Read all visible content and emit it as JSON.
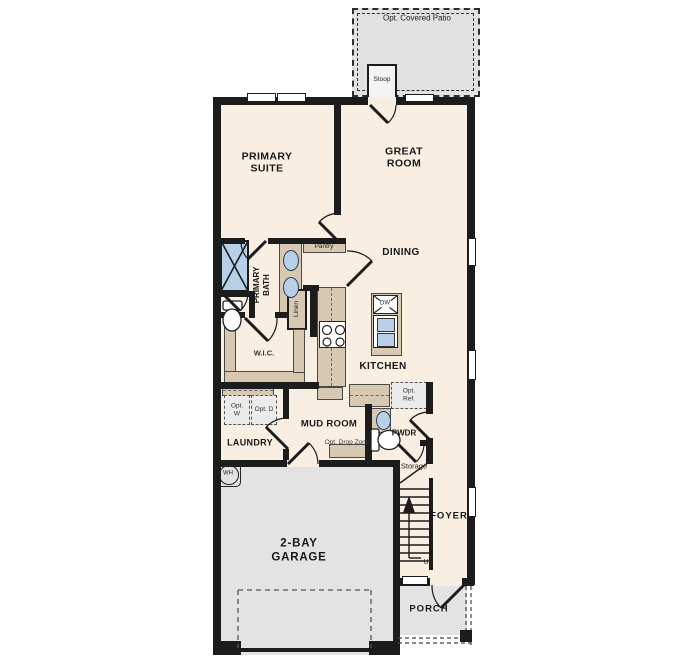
{
  "plan": {
    "rooms": {
      "primary_suite": "PRIMARY SUITE",
      "great_room": "GREAT ROOM",
      "dining": "DINING",
      "kitchen": "KITCHEN",
      "primary_bath": "PRIMARY BATH",
      "wic": "W.I.C.",
      "laundry": "LAUNDRY",
      "mud_room": "MUD ROOM",
      "pwdr": "PWDR",
      "foyer": "FOYER",
      "garage": "2-BAY GARAGE",
      "porch": "PORCH"
    },
    "features": {
      "opt_covered_patio": "Opt. Covered Patio",
      "stoop": "Stoop",
      "pantry": "Pantry",
      "linen": "Linen",
      "opt_w": "Opt. W",
      "opt_d": "Opt. D",
      "opt_ref": "Opt. Ref.",
      "opt_drop_zone": "Opt. Drop Zone",
      "storage": "Storage",
      "up": "Up",
      "wh": "WH",
      "dw": "DW"
    },
    "colors": {
      "floor": "#f8efe2",
      "garage_floor": "#e3e3e3",
      "patio_floor": "#e1e1e1",
      "counter": "#d7c9b1",
      "water_fixture": "#b7d0e8",
      "wall": "#1c1c1c"
    }
  }
}
